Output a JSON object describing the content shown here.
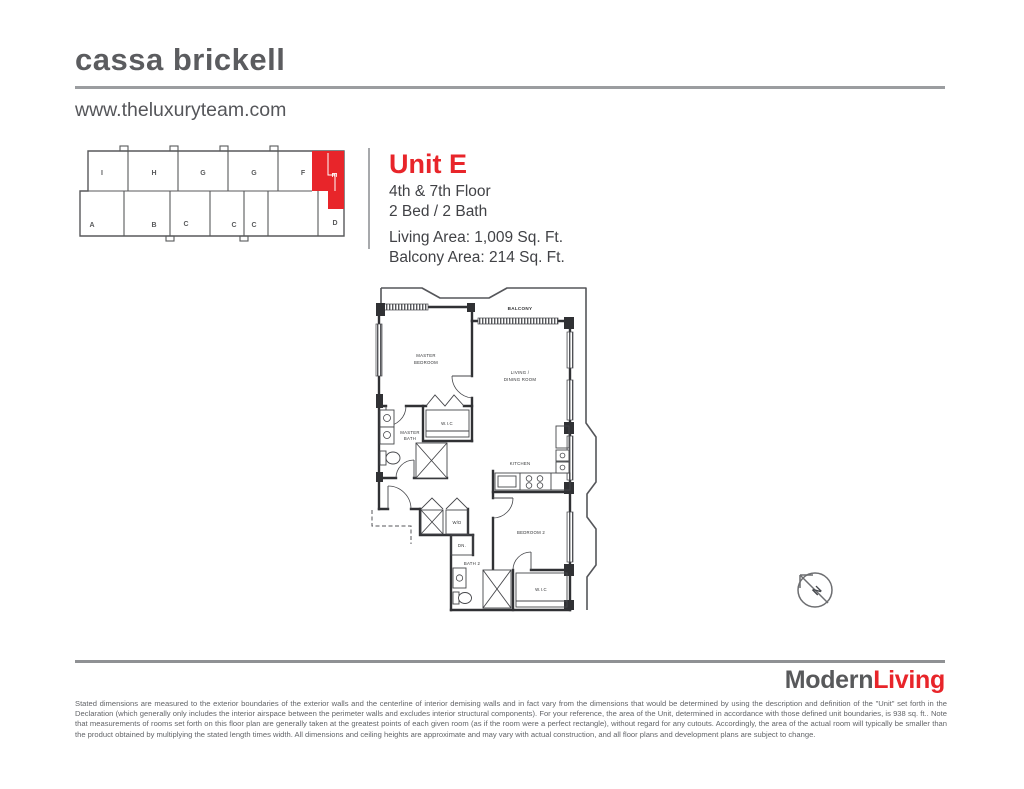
{
  "header": {
    "title": "cassa brickell",
    "website": "www.theluxuryteam.com"
  },
  "unit": {
    "name": "Unit E",
    "floors": "4th & 7th Floor",
    "bed_bath": "2 Bed / 2 Bath",
    "living_area": "Living Area: 1,009 Sq. Ft.",
    "balcony_area": "Balcony Area: 214 Sq. Ft."
  },
  "keyplan": {
    "top_row": [
      "I",
      "H",
      "G",
      "G",
      "F"
    ],
    "highlight": "E",
    "bottom_row": [
      "A",
      "B",
      "C",
      "C",
      "C",
      "D"
    ],
    "highlight_color": "#e8252a"
  },
  "plan": {
    "balcony": "BALCONY",
    "master_1": "MASTER",
    "master_2": "BEDROOM",
    "living_1": "LIVING /",
    "living_2": "DINING ROOM",
    "wic": "W.I.C",
    "master_bath_1": "MASTER",
    "master_bath_2": "BATH",
    "kitchen": "KITCHEN",
    "wd": "W/D",
    "dn": "DN.",
    "bath2": "BATH 2",
    "bedroom2": "BEDROOM 2",
    "wic2": "W.I.C",
    "north": "N"
  },
  "branding": {
    "modern": "Modern",
    "living": "Living",
    "accent_color": "#e8252a",
    "gray_color": "#58595b"
  },
  "disclaimer": "Stated dimensions are measured to the exterior boundaries of the exterior walls and the centerline of interior demising walls and in fact vary from the dimensions that would be determined by using the description and definition of the \"Unit\" set forth in the Declaration (which generally only includes the interior airspace between the perimeter walls and excludes interior structural components). For your reference, the area of the Unit, determined in accordance with those defined unit boundaries, is 938 sq. ft.. Note that measurements of rooms set forth on this floor plan are generally taken at the greatest points of each given room (as if the room were a perfect rectangle), without regard for any cutouts. Accordingly, the area of the actual room will typically be smaller than the product obtained by multiplying the stated length times width. All dimensions and ceiling heights are approximate and may vary with actual construction, and all floor plans and development plans are subject to change."
}
